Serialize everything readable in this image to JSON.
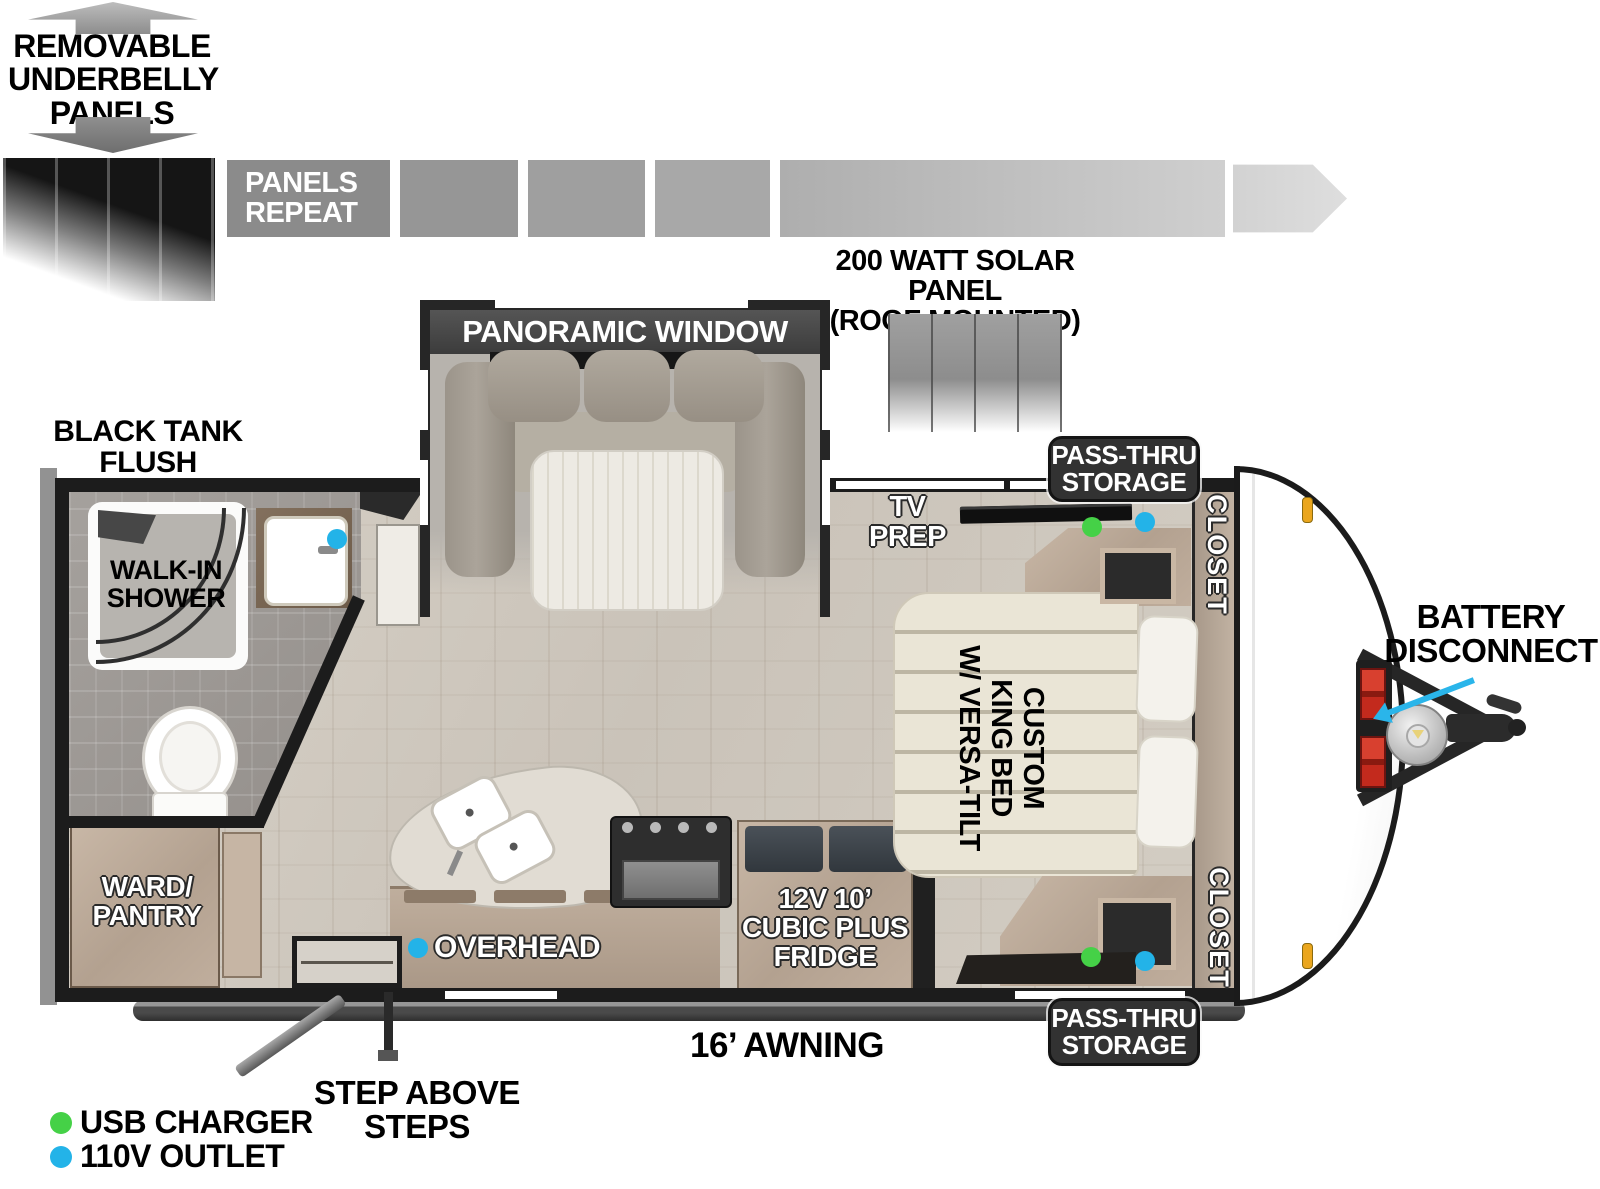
{
  "colors": {
    "usb_charger": "#45d147",
    "outlet_110v": "#23b3e8",
    "callout_arrow": "#2ab5ea",
    "battery": "#c32a1d",
    "marker_light": "#eaa61e"
  },
  "underbelly": {
    "note": "REMOVABLE\nUNDERBELLY\nPANELS",
    "strip_label": "PANELS\nREPEAT"
  },
  "roof": {
    "solar_label": "200 WATT SOLAR PANEL\n(ROOF MOUNTED)"
  },
  "exterior": {
    "black_tank_flush": "BLACK TANK\nFLUSH",
    "pass_thru_storage_top": "PASS-THRU\nSTORAGE",
    "pass_thru_storage_bottom": "PASS-THRU\nSTORAGE",
    "battery_disconnect": "BATTERY\nDISCONNECT",
    "awning": "16’ AWNING",
    "steps": "STEP ABOVE STEPS"
  },
  "rooms": {
    "panoramic_window": "PANORAMIC WINDOW",
    "walk_in_shower": "WALK-IN\nSHOWER",
    "ward_pantry": "WARD/\nPANTRY",
    "overhead": "OVERHEAD",
    "fridge": "12V 10’\nCUBIC PLUS\nFRIDGE",
    "tv_prep": "TV\nPREP",
    "closet_top": "CLOSET",
    "closet_bottom": "CLOSET",
    "king_bed": "CUSTOM\nKING BED\nW/ VERSA-TILT"
  },
  "legend": {
    "usb": {
      "label": "USB CHARGER",
      "color": "#45d147"
    },
    "outlet": {
      "label": "110V OUTLET",
      "color": "#23b3e8"
    }
  }
}
